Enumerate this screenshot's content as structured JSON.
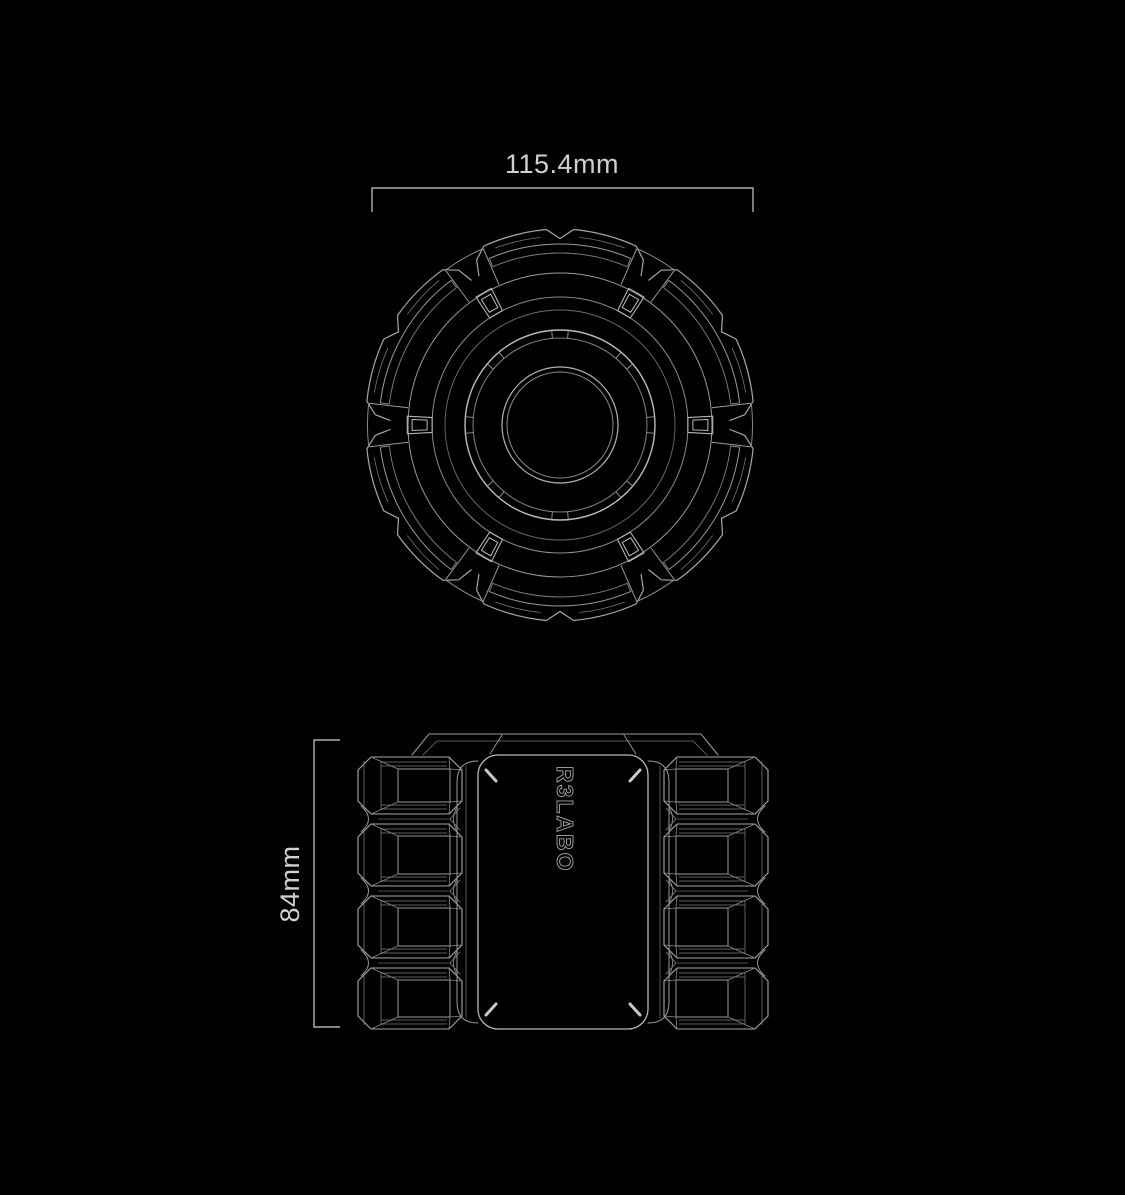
{
  "canvas": {
    "background_color": "#000000",
    "line_color_primary": "#a8a8a8",
    "line_color_secondary": "#8a8a8a",
    "line_color_dim": "#777777",
    "line_color_bright": "#c8c8c8",
    "dimension_color": "#d0d0d0"
  },
  "top_view": {
    "dimension_label": "115.4mm"
  },
  "side_view": {
    "dimension_label": "84mm",
    "engraving_text": "R3LABO"
  }
}
